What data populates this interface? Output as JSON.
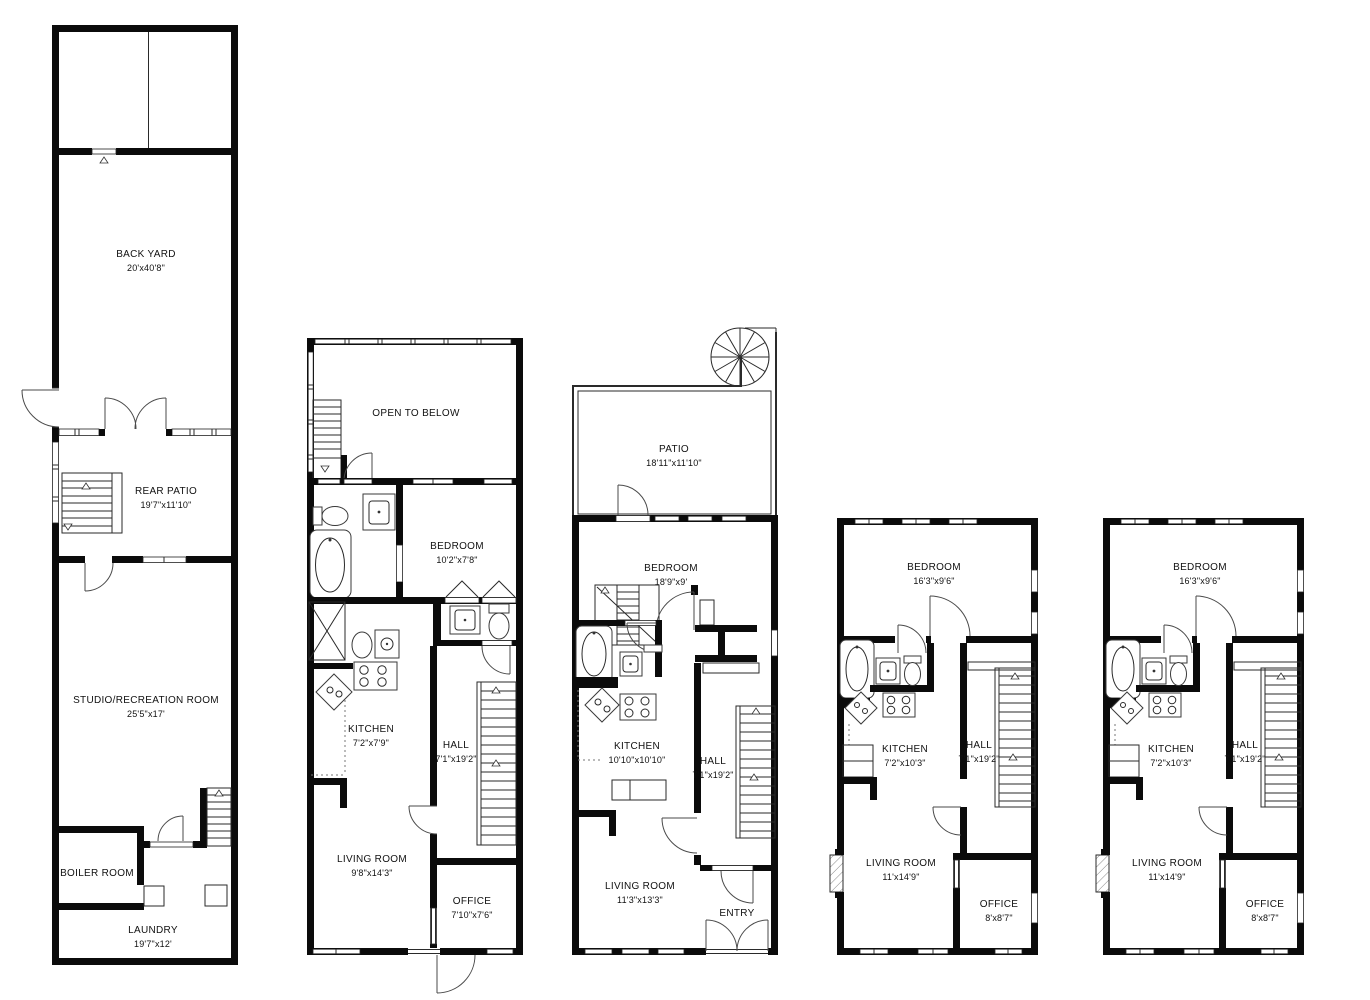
{
  "plans": [
    {
      "id": "garden-level",
      "rooms": [
        {
          "name": "BACK YARD",
          "dims": "20'x40'8\""
        },
        {
          "name": "REAR PATIO",
          "dims": "19'7\"x11'10\""
        },
        {
          "name": "STUDIO/RECREATION ROOM",
          "dims": "25'5\"x17'"
        },
        {
          "name": "BOILER ROOM",
          "dims": ""
        },
        {
          "name": "LAUNDRY",
          "dims": "19'7\"x12'"
        }
      ]
    },
    {
      "id": "duplex-upper",
      "rooms": [
        {
          "name": "OPEN TO BELOW",
          "dims": ""
        },
        {
          "name": "BEDROOM",
          "dims": "10'2\"x7'8\""
        },
        {
          "name": "KITCHEN",
          "dims": "7'2\"x7'9\""
        },
        {
          "name": "HALL",
          "dims": "7'1\"x19'2\""
        },
        {
          "name": "LIVING ROOM",
          "dims": "9'8\"x14'3\""
        },
        {
          "name": "OFFICE",
          "dims": "7'10\"x7'6\""
        }
      ]
    },
    {
      "id": "parlor-floor",
      "rooms": [
        {
          "name": "PATIO",
          "dims": "18'11\"x11'10\""
        },
        {
          "name": "BEDROOM",
          "dims": "18'9\"x9'"
        },
        {
          "name": "KITCHEN",
          "dims": "10'10\"x10'10\""
        },
        {
          "name": "HALL",
          "dims": "7'1\"x19'2\""
        },
        {
          "name": "LIVING ROOM",
          "dims": "11'3\"x13'3\""
        },
        {
          "name": "ENTRY",
          "dims": ""
        }
      ]
    },
    {
      "id": "third-floor",
      "rooms": [
        {
          "name": "BEDROOM",
          "dims": "16'3\"x9'6\""
        },
        {
          "name": "KITCHEN",
          "dims": "7'2\"x10'3\""
        },
        {
          "name": "HALL",
          "dims": "7'1\"x19'2\""
        },
        {
          "name": "LIVING ROOM",
          "dims": "11'x14'9\""
        },
        {
          "name": "OFFICE",
          "dims": "8'x8'7\""
        }
      ]
    },
    {
      "id": "fourth-floor",
      "rooms": [
        {
          "name": "BEDROOM",
          "dims": "16'3\"x9'6\""
        },
        {
          "name": "KITCHEN",
          "dims": "7'2\"x10'3\""
        },
        {
          "name": "HALL",
          "dims": "7'1\"x19'2\""
        },
        {
          "name": "LIVING ROOM",
          "dims": "11'x14'9\""
        },
        {
          "name": "OFFICE",
          "dims": "8'x8'7\""
        }
      ]
    }
  ],
  "colors": {
    "line": "#0b0b0b",
    "background": "#ffffff"
  }
}
